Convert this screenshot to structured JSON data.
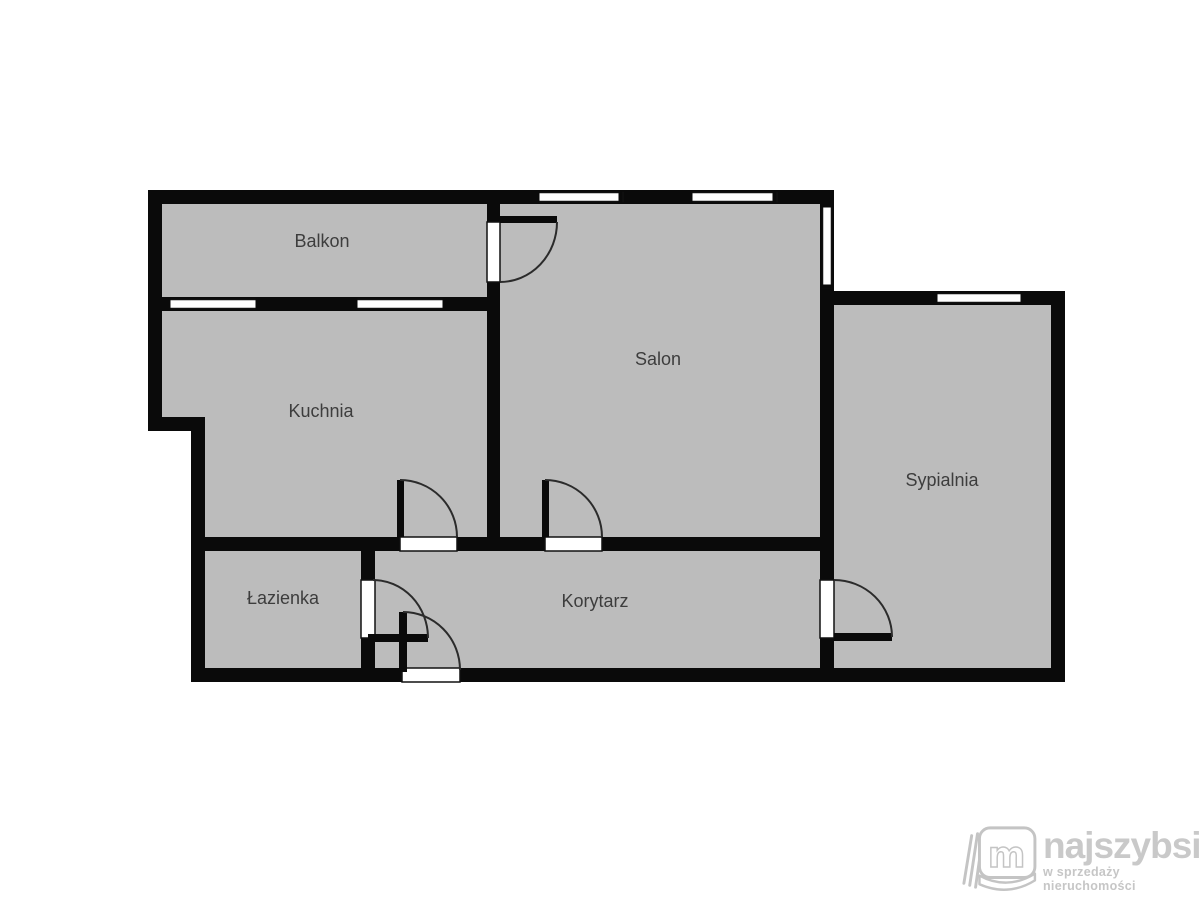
{
  "floorplan": {
    "colors": {
      "wall": "#0a0a0a",
      "room_fill": "#bcbcbc",
      "window_fill": "#ffffff",
      "label_text": "#3d3d3d",
      "background": "#ffffff"
    },
    "rooms": [
      {
        "id": "balkon",
        "name": "Balkon"
      },
      {
        "id": "kuchnia",
        "name": "Kuchnia"
      },
      {
        "id": "salon",
        "name": "Salon"
      },
      {
        "id": "sypialnia",
        "name": "Sypialnia"
      },
      {
        "id": "lazienka",
        "name": "Łazienka"
      },
      {
        "id": "korytarz",
        "name": "Korytarz"
      }
    ]
  },
  "watermark": {
    "brand": "najszybsi",
    "tagline": "w sprzedaży nieruchomości",
    "icon": "open-book-m-icon",
    "icon_letter": "m",
    "color": "#c9c9c9"
  }
}
